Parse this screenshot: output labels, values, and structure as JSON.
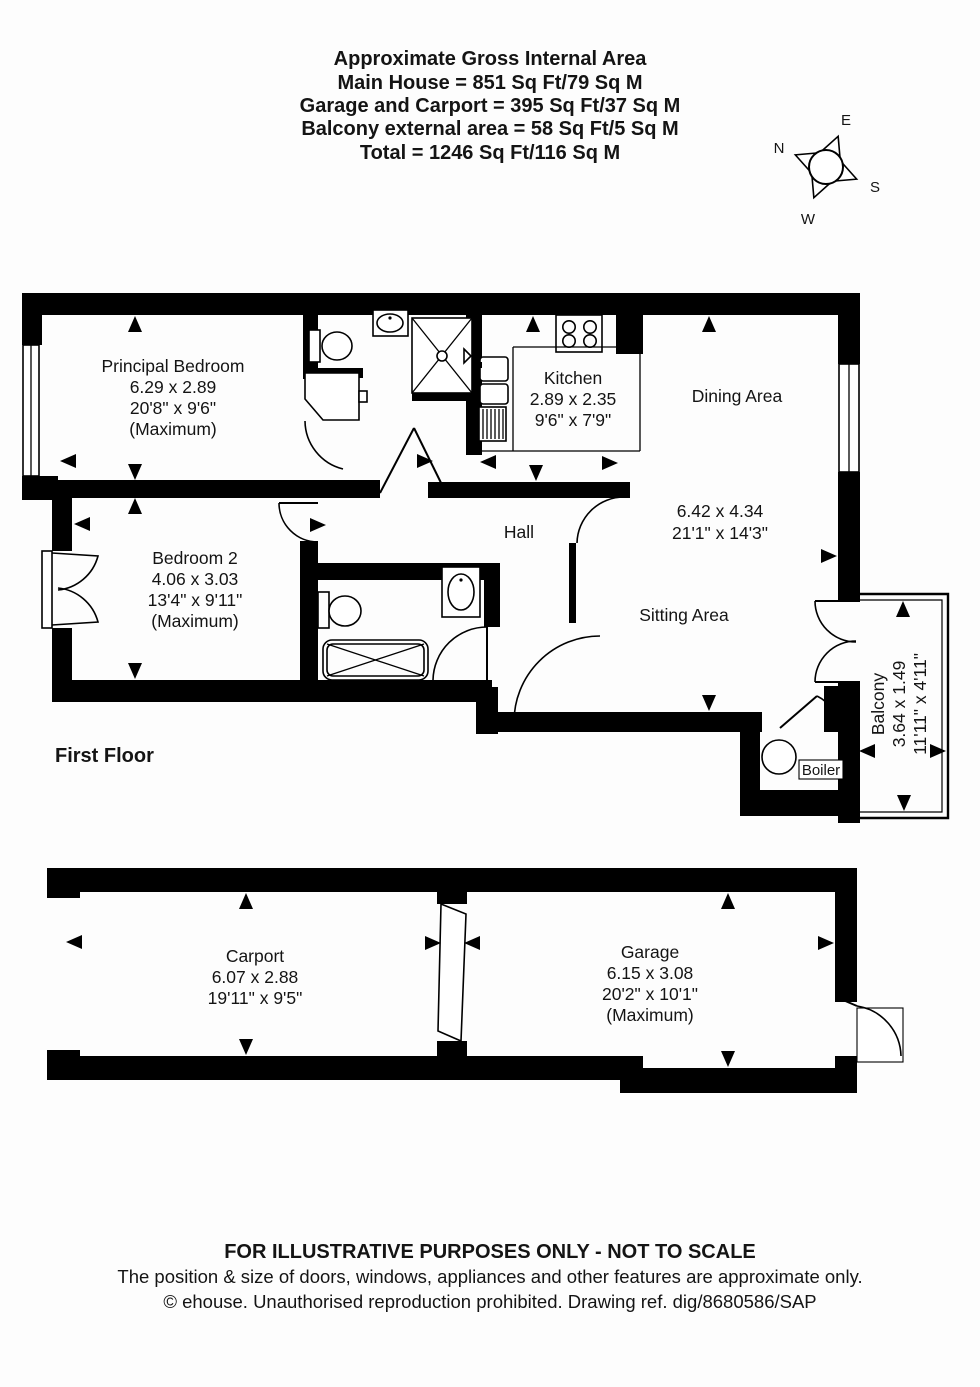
{
  "header": {
    "line1": "Approximate Gross Internal Area",
    "line2": "Main House = 851 Sq Ft/79 Sq M",
    "line3": "Garage and Carport = 395 Sq Ft/37 Sq M",
    "line4": "Balcony external area = 58 Sq Ft/5 Sq M",
    "line5": "Total = 1246 Sq Ft/116 Sq M"
  },
  "compass": {
    "north": "N",
    "east": "E",
    "south": "S",
    "west": "W"
  },
  "floor": {
    "label": "First Floor"
  },
  "rooms": {
    "principal_bedroom": {
      "name": "Principal Bedroom",
      "metric": "6.29 x 2.89",
      "imperial": "20'8\" x 9'6\"",
      "note": "(Maximum)"
    },
    "kitchen": {
      "name": "Kitchen",
      "metric": "2.89 x 2.35",
      "imperial": "9'6\" x 7'9\""
    },
    "dining_area": {
      "name": "Dining Area"
    },
    "reception": {
      "metric": "6.42 x 4.34",
      "imperial": "21'1\" x 14'3\""
    },
    "hall": {
      "name": "Hall"
    },
    "bedroom_2": {
      "name": "Bedroom 2",
      "metric": "4.06 x 3.03",
      "imperial": "13'4\" x 9'11\"",
      "note": "(Maximum)"
    },
    "sitting_area": {
      "name": "Sitting Area"
    },
    "boiler": {
      "name": "Boiler"
    },
    "balcony": {
      "name": "Balcony",
      "metric": "3.64 x 1.49",
      "imperial": "11'11\" x 4'11\""
    },
    "carport": {
      "name": "Carport",
      "metric": "6.07 x 2.88",
      "imperial": "19'11\" x 9'5\""
    },
    "garage": {
      "name": "Garage",
      "metric": "6.15 x 3.08",
      "imperial": "20'2\" x 10'1\"",
      "note": "(Maximum)"
    }
  },
  "footer": {
    "line1": "FOR ILLUSTRATIVE PURPOSES ONLY - NOT TO SCALE",
    "line2": "The position & size of doors, windows, appliances and other features are approximate only.",
    "line3": "© ehouse. Unauthorised reproduction prohibited. Drawing ref. dig/8680586/SAP"
  },
  "colors": {
    "wall": "#000000",
    "background": "#fdfdfd",
    "text": "#141414"
  }
}
